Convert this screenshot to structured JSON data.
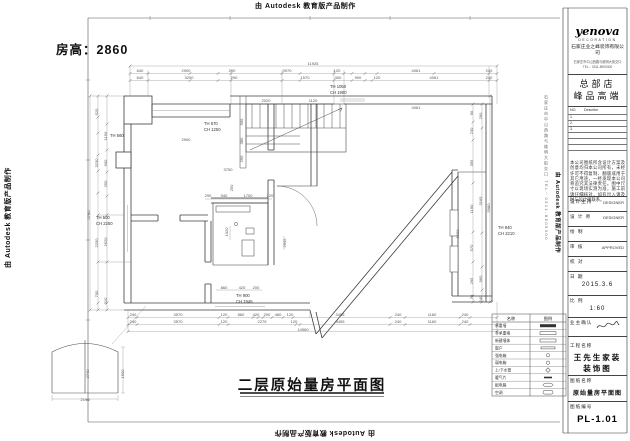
{
  "watermark": {
    "text": "由 Autodesk 教育版产品制作"
  },
  "frame": {
    "side_text": "石家庄市中山西路与维明大街交口 TEL：0311-8905300"
  },
  "plan": {
    "room_height": "房高：2860",
    "title": "二层原始量房平面图",
    "dim_texts": [
      {
        "t": "11925",
        "x": 313,
        "y": 65
      },
      {
        "t": "640",
        "x": 140,
        "y": 72
      },
      {
        "t": "2900",
        "x": 186,
        "y": 72
      },
      {
        "t": "290",
        "x": 232,
        "y": 72
      },
      {
        "t": "3970",
        "x": 287,
        "y": 72
      },
      {
        "t": "120",
        "x": 337,
        "y": 72
      },
      {
        "t": "4061",
        "x": 416,
        "y": 72
      },
      {
        "t": "240",
        "x": 489,
        "y": 72
      },
      {
        "t": "640",
        "x": 140,
        "y": 79
      },
      {
        "t": "3200",
        "x": 189,
        "y": 79
      },
      {
        "t": "290",
        "x": 234,
        "y": 79
      },
      {
        "t": "1570",
        "x": 305,
        "y": 79
      },
      {
        "t": "400",
        "x": 338,
        "y": 79
      },
      {
        "t": "900",
        "x": 358,
        "y": 79
      },
      {
        "t": "120",
        "x": 377,
        "y": 79
      },
      {
        "t": "4061",
        "x": 434,
        "y": 79
      },
      {
        "t": "240",
        "x": 489,
        "y": 79
      },
      {
        "t": "2020",
        "x": 266,
        "y": 102
      },
      {
        "t": "1120",
        "x": 313,
        "y": 102
      },
      {
        "t": "900",
        "x": 243,
        "y": 122,
        "r": 1
      },
      {
        "t": "380",
        "x": 243,
        "y": 141,
        "r": 1
      },
      {
        "t": "290",
        "x": 243,
        "y": 159,
        "r": 1
      },
      {
        "t": "250",
        "x": 233,
        "y": 188,
        "r": 1
      },
      {
        "t": "2900",
        "x": 186,
        "y": 141
      },
      {
        "t": "3750",
        "x": 228,
        "y": 171
      },
      {
        "t": "4061",
        "x": 416,
        "y": 109
      },
      {
        "t": "5780",
        "x": 90,
        "y": 215,
        "r": 1
      },
      {
        "t": "520",
        "x": 98,
        "y": 112,
        "r": 1
      },
      {
        "t": "3230",
        "x": 98,
        "y": 163,
        "r": 1
      },
      {
        "t": "2250",
        "x": 98,
        "y": 243,
        "r": 1
      },
      {
        "t": "700",
        "x": 98,
        "y": 294,
        "r": 1
      },
      {
        "t": "1150",
        "x": 107,
        "y": 136,
        "r": 1
      },
      {
        "t": "900",
        "x": 107,
        "y": 163,
        "r": 1
      },
      {
        "t": "250",
        "x": 107,
        "y": 184,
        "r": 1
      },
      {
        "t": "2620",
        "x": 107,
        "y": 242,
        "r": 1
      },
      {
        "t": "310",
        "x": 107,
        "y": 301,
        "r": 1
      },
      {
        "t": "5980",
        "x": 490,
        "y": 208,
        "r": 1
      },
      {
        "t": "95",
        "x": 473,
        "y": 113,
        "r": 1
      },
      {
        "t": "230",
        "x": 473,
        "y": 131,
        "r": 1
      },
      {
        "t": "395",
        "x": 473,
        "y": 163,
        "r": 1
      },
      {
        "t": "1190",
        "x": 473,
        "y": 209,
        "r": 1
      },
      {
        "t": "570",
        "x": 473,
        "y": 248,
        "r": 1
      },
      {
        "t": "295",
        "x": 473,
        "y": 281,
        "r": 1
      },
      {
        "t": "70",
        "x": 473,
        "y": 297,
        "r": 1
      },
      {
        "t": "290",
        "x": 482,
        "y": 116,
        "r": 1
      },
      {
        "t": "3165",
        "x": 482,
        "y": 201,
        "r": 1
      },
      {
        "t": "960",
        "x": 482,
        "y": 279,
        "r": 1
      },
      {
        "t": "240",
        "x": 482,
        "y": 299,
        "r": 1
      },
      {
        "t": "1900",
        "x": 459,
        "y": 234,
        "r": 1
      },
      {
        "t": "290",
        "x": 208,
        "y": 197
      },
      {
        "t": "940",
        "x": 224,
        "y": 197
      },
      {
        "t": "1700",
        "x": 248,
        "y": 197
      },
      {
        "t": "120",
        "x": 270,
        "y": 197
      },
      {
        "t": "1020",
        "x": 228,
        "y": 232,
        "r": 1
      },
      {
        "t": "2905",
        "x": 286,
        "y": 243,
        "r": 1
      },
      {
        "t": "860",
        "x": 224,
        "y": 289
      },
      {
        "t": "420",
        "x": 242,
        "y": 289
      },
      {
        "t": "200",
        "x": 256,
        "y": 289
      },
      {
        "t": "240",
        "x": 133,
        "y": 316
      },
      {
        "t": "3570",
        "x": 178,
        "y": 316
      },
      {
        "t": "120",
        "x": 224,
        "y": 316
      },
      {
        "t": "860",
        "x": 241,
        "y": 316
      },
      {
        "t": "420",
        "x": 256,
        "y": 316
      },
      {
        "t": "200",
        "x": 267,
        "y": 316
      },
      {
        "t": "460",
        "x": 278,
        "y": 316
      },
      {
        "t": "120",
        "x": 290,
        "y": 316
      },
      {
        "t": "3455",
        "x": 340,
        "y": 316
      },
      {
        "t": "240",
        "x": 398,
        "y": 316
      },
      {
        "t": "1160",
        "x": 432,
        "y": 316
      },
      {
        "t": "240",
        "x": 465,
        "y": 316
      },
      {
        "t": "240",
        "x": 133,
        "y": 323
      },
      {
        "t": "3570",
        "x": 178,
        "y": 323
      },
      {
        "t": "120",
        "x": 224,
        "y": 323
      },
      {
        "t": "2275",
        "x": 262,
        "y": 323
      },
      {
        "t": "120",
        "x": 294,
        "y": 323
      },
      {
        "t": "3455",
        "x": 340,
        "y": 323
      },
      {
        "t": "240",
        "x": 398,
        "y": 323
      },
      {
        "t": "1160",
        "x": 432,
        "y": 323
      },
      {
        "t": "240",
        "x": 465,
        "y": 323
      },
      {
        "t": "14960",
        "x": 303,
        "y": 331
      },
      {
        "t": "2190",
        "x": 85,
        "y": 401
      },
      {
        "t": "1500",
        "x": 124,
        "y": 374,
        "r": 1
      },
      {
        "t": "2740",
        "x": 89,
        "y": 374,
        "r": 1
      }
    ],
    "annotations": [
      {
        "t": "TH 560",
        "x": 110,
        "y": 137
      },
      {
        "t": "TH 670",
        "x": 204,
        "y": 125
      },
      {
        "t": "CH 1250",
        "x": 204,
        "y": 131
      },
      {
        "t": "TH 1050",
        "x": 330,
        "y": 88
      },
      {
        "t": "CH 1900",
        "x": 330,
        "y": 94
      },
      {
        "t": "TH 500",
        "x": 96,
        "y": 219
      },
      {
        "t": "CH 2250",
        "x": 96,
        "y": 225
      },
      {
        "t": "TH 940",
        "x": 498,
        "y": 229
      },
      {
        "t": "CH 2210",
        "x": 498,
        "y": 235
      },
      {
        "t": "TH 900",
        "x": 236,
        "y": 297
      },
      {
        "t": "CH 1945",
        "x": 236,
        "y": 303
      }
    ]
  },
  "legend": {
    "header_name": "名称",
    "header_symbol": "图例",
    "rows": [
      {
        "label": "承重墙",
        "sym": "solid"
      },
      {
        "label": "非承重墙",
        "sym": "hollow"
      },
      {
        "label": "新建墙体",
        "sym": "hollow"
      },
      {
        "label": "窗户",
        "sym": "thin"
      },
      {
        "label": "强电箱",
        "sym": "circle"
      },
      {
        "label": "弱电箱",
        "sym": "circle"
      },
      {
        "label": "上/下水管",
        "sym": "diamond"
      },
      {
        "label": "暖气片",
        "sym": "dash"
      },
      {
        "label": "配电箱",
        "sym": "oval"
      },
      {
        "label": "空调",
        "sym": "round"
      }
    ]
  },
  "title_block": {
    "logo": "yenova",
    "logo_sub": "DECORATION",
    "company": "石家庄业之峰装饰有限公司",
    "address_line1": "石家庄市中山西路与维明大街交口",
    "address_line2": "TEL：0311-8905300",
    "store_line1": "总部店",
    "store_line2": "峰品高端",
    "table_no": "NO.",
    "table_desc": "Describe",
    "table_rows": [
      "1.",
      "2.",
      "3."
    ],
    "notes": "本公司图纸所含设计方案及创意均归本公司所有，未经许可不得复制、翻版或用于其它用途，一经发现本公司将追究其法律责任。图中尺寸以现场实测为准，施工前请仔细核对，如有出入请及时与设计师联系。",
    "fields": [
      {
        "label": "设计主持",
        "value": "DESIGNER"
      },
      {
        "label": "设 计 师",
        "value": "DESIGNER"
      },
      {
        "label": "绘  制",
        "value": ""
      },
      {
        "label": "审  核",
        "value": "APPROVED"
      },
      {
        "label": "校  对",
        "value": ""
      },
      {
        "label": "日  期",
        "value": "2015.3.6"
      },
      {
        "label": "比  例",
        "value": "1:60"
      },
      {
        "label": "业主确认",
        "value": ""
      }
    ],
    "project_label": "工程名称",
    "project_line1": "王先生家装",
    "project_line2": "装饰图",
    "drawing_label": "图纸名称",
    "drawing_name": "原始量房平面图",
    "number_label": "图纸编号",
    "number": "PL-1.01"
  }
}
